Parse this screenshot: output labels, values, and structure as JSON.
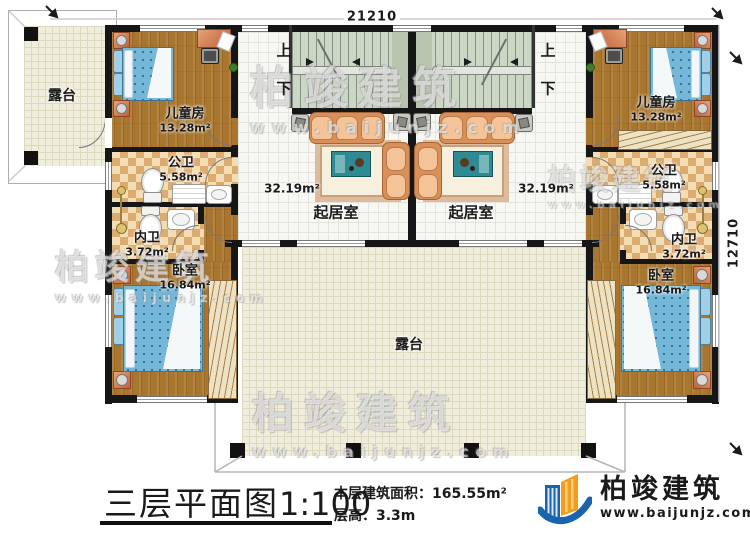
{
  "dimensions": {
    "top": "21210",
    "right": "12710"
  },
  "stairs": {
    "up": "上",
    "down": "下"
  },
  "rooms": {
    "terrace_left": {
      "name": "露台"
    },
    "terrace_bottom": {
      "name": "露台"
    },
    "child_left": {
      "name": "儿童房",
      "area": "13.28m²"
    },
    "child_right": {
      "name": "儿童房",
      "area": "13.28m²"
    },
    "pub_bath_left": {
      "name": "公卫",
      "area": "5.58m²"
    },
    "pub_bath_right": {
      "name": "公卫",
      "area": "5.58m²"
    },
    "pri_bath_left": {
      "name": "内卫",
      "area": "3.72m²"
    },
    "pri_bath_right": {
      "name": "内卫",
      "area": "3.72m²"
    },
    "bedroom_left": {
      "name": "卧室",
      "area": "16.84m²"
    },
    "bedroom_right": {
      "name": "卧室",
      "area": "16.84m²"
    },
    "living_left": {
      "name": "起居室",
      "area": "32.19m²"
    },
    "living_right": {
      "name": "起居室",
      "area": "32.19m²"
    }
  },
  "title": {
    "main": "三层平面图",
    "scale": "1:100",
    "floor_area_label": "本层建筑面积：",
    "floor_area_value": "165.55m²",
    "floor_height_label": "层高：",
    "floor_height_value": "3.3m"
  },
  "logo": {
    "name": "柏竣建筑",
    "url": "www.baijunjz.com"
  },
  "watermark": {
    "name": "柏竣建筑",
    "url": "www.baijunjz.com"
  },
  "colors": {
    "wall": "#161616",
    "wood_floor": "#a9762f",
    "bath_tile": "#dcab70",
    "stair_floor": "#ccd6c5",
    "terrace_floor": "#efeedd",
    "bed_blue": "#74b7d9",
    "sofa_tan": "#d99058",
    "table_teal": "#2e8a93",
    "logo_blue": "#1a63ad",
    "logo_orange": "#f59c1a"
  }
}
